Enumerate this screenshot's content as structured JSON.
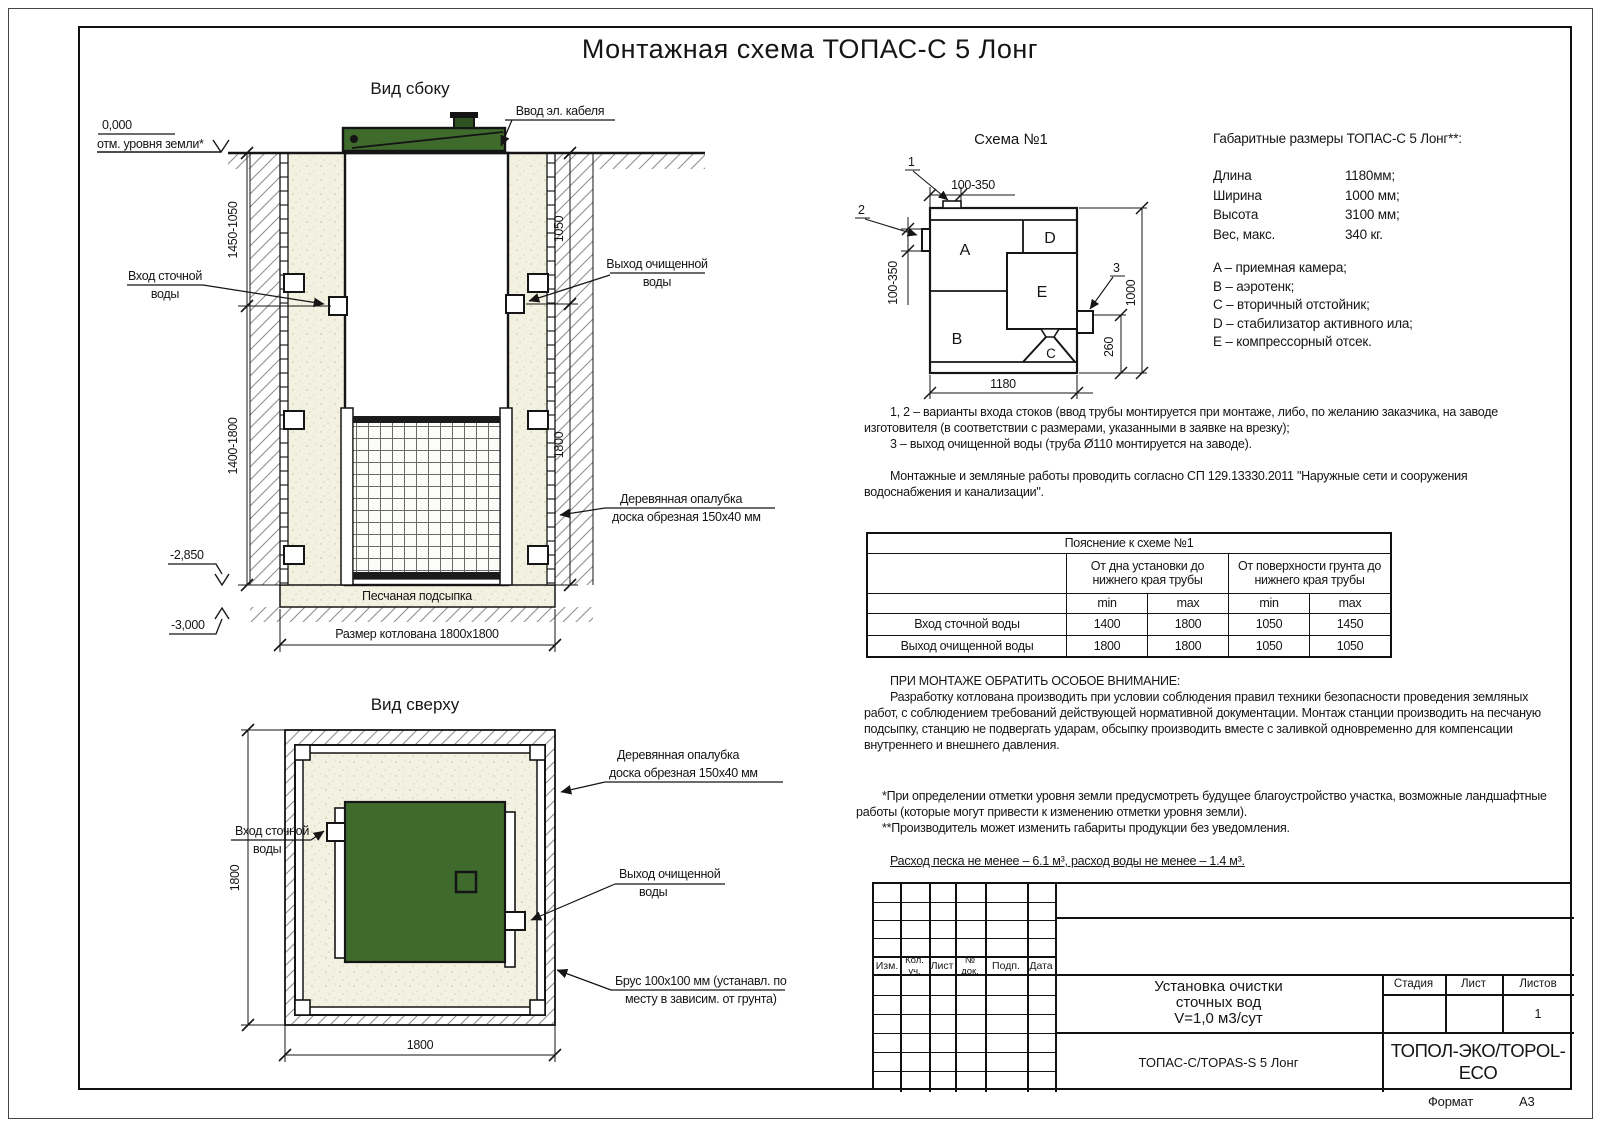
{
  "sheet": {
    "title": "Монтажная схема ТОПАС-С 5 Лонг",
    "format_label": "Формат",
    "format_value": "А3"
  },
  "side_view": {
    "title": "Вид сбоку",
    "labels": {
      "cable": "Ввод эл. кабеля",
      "zero_mark": "0,000",
      "ground_level": "отм. уровня земли*",
      "inlet_1": "Вход сточной",
      "inlet_2": "воды",
      "outlet_1": "Выход очищенной",
      "outlet_2": "воды",
      "formwork_1": "Деревянная опалубка",
      "formwork_2": "доска обрезная 150х40 мм",
      "sand_bed": "Песчаная подсыпка",
      "pit_size": "Размер котлована 1800х1800",
      "level_2850": "-2,850",
      "level_3000": "-3,000"
    },
    "dims": {
      "left_top": "1450-1050",
      "left_bottom": "1400-1800",
      "right_top": "1050",
      "right_bottom": "1800"
    }
  },
  "top_view": {
    "title": "Вид сверху",
    "labels": {
      "inlet_1": "Вход сточной",
      "inlet_2": "воды",
      "formwork_1": "Деревянная опалубка",
      "formwork_2": "доска обрезная 150х40 мм",
      "outlet_1": "Выход очищенной",
      "outlet_2": "воды",
      "beam_1": "Брус 100х100 мм (устанавл. по",
      "beam_2": "месту в зависим. от грунта)"
    },
    "dims": {
      "width": "1800",
      "height": "1800"
    }
  },
  "schema": {
    "title": "Схема №1",
    "compartments": {
      "a": "A",
      "b": "B",
      "c": "C",
      "d": "D",
      "e": "E"
    },
    "callouts": {
      "c1": "1",
      "c2": "2",
      "c3": "3"
    },
    "dims": {
      "top": "100-350",
      "left": "100-350",
      "right": "1000",
      "outlet": "260",
      "bottom": "1180"
    }
  },
  "specs": {
    "heading": "Габаритные размеры ТОПАС-С 5 Лонг**:",
    "rows": [
      {
        "label": "Длина",
        "value": "1180мм;"
      },
      {
        "label": "Ширина",
        "value": "1000 мм;"
      },
      {
        "label": "Высота",
        "value": "3100 мм;"
      },
      {
        "label": "Вес, макс.",
        "value": "340 кг."
      }
    ],
    "legend": [
      "A – приемная камера;",
      "B – аэротенк;",
      "C – вторичный отстойник;",
      "D – стабилизатор активного ила;",
      "E – компрессорный отсек."
    ]
  },
  "notes": {
    "p1": "1, 2 – варианты входа  стоков (ввод трубы монтируется при монтаже, либо, по желанию заказчика, на заводе изготовителя (в соответствии с размерами, указанными в заявке на врезку);",
    "p2": "3 – выход очищенной воды (труба Ø110 монтируется на заводе).",
    "p3": "Монтажные и земляные работы проводить согласно СП 129.13330.2011 \"Наружные сети и сооружения водоснабжения и канализации\"."
  },
  "table": {
    "caption": "Пояснение к схеме №1",
    "col_group_1": "От дна установки до нижнего края трубы",
    "col_group_2": "От поверхности грунта до нижнего края трубы",
    "min1": "min",
    "max1": "max",
    "min2": "min",
    "max2": "max",
    "rows": [
      {
        "label": "Вход сточной воды",
        "v1": "1400",
        "v2": "1800",
        "v3": "1050",
        "v4": "1450"
      },
      {
        "label": "Выход очищенной воды",
        "v1": "1800",
        "v2": "1800",
        "v3": "1050",
        "v4": "1050"
      }
    ]
  },
  "attention": {
    "heading": "ПРИ МОНТАЖЕ ОБРАТИТЬ ОСОБОЕ ВНИМАНИЕ:",
    "body": "Разработку котлована производить при условии соблюдения правил техники безопасности проведения земляных работ, с соблюдением требований действующей нормативной документации. Монтаж станции производить на песчаную подсыпку, станцию не подвергать ударам, обсыпку производить вместе с заливкой одновременно для компенсации внутреннего и внешнего давления."
  },
  "footnotes": {
    "f1": "*При определении отметки уровня земли предусмотреть будущее благоустройство участка, возможные ландшафтные работы (которые могут привести к изменению отметки уровня земли).",
    "f2": "**Производитель может изменить габариты продукции без уведомления.",
    "consumption": "Расход песка не менее – 6.1 м³, расход воды не менее – 1.4 м³."
  },
  "titleblock": {
    "rev_headers": [
      "Изм.",
      "Кол. уч.",
      "Лист",
      "№ док.",
      "Подп.",
      "Дата"
    ],
    "product_title_1": "Установка очистки",
    "product_title_2": "сточных вод",
    "product_title_3": "V=1,0 м3/сут",
    "stage_label": "Стадия",
    "sheet_label": "Лист",
    "sheets_label": "Листов",
    "sheets_value": "1",
    "model": "ТОПАС-С/TOPAS-S 5 Лонг",
    "company": "ТОПОЛ-ЭКО/TOPOL-ECO"
  },
  "colors": {
    "green": "#3e6b2c",
    "sand": "#f3f1e1",
    "line": "#151515"
  }
}
